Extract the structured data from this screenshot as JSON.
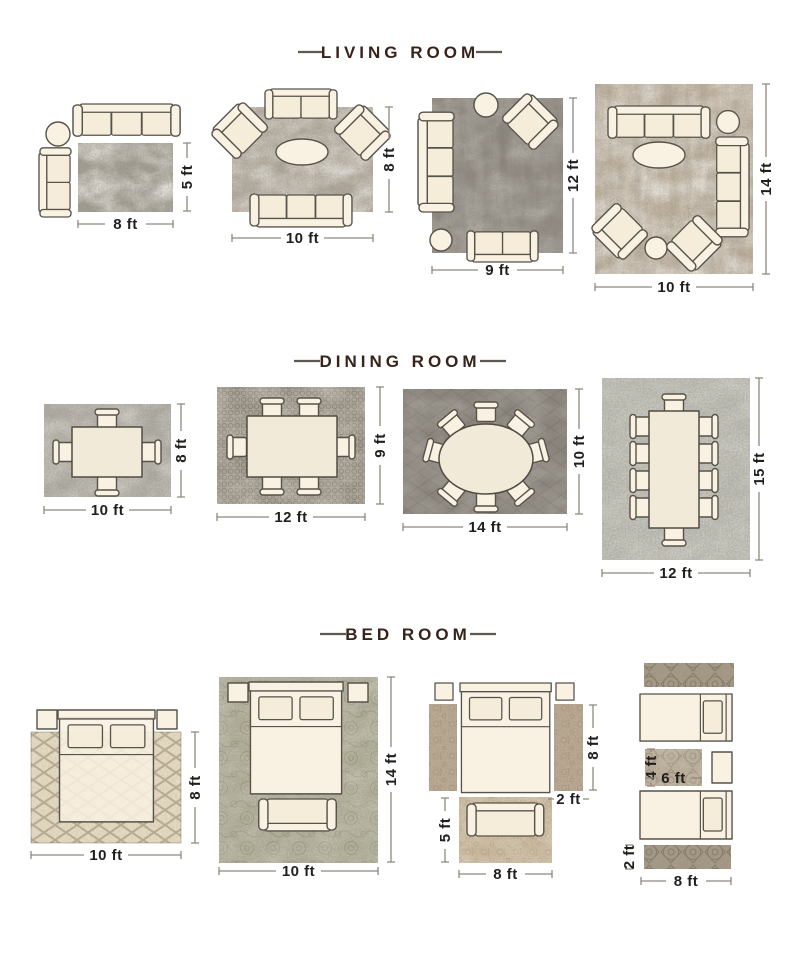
{
  "sections": [
    {
      "title": "LIVING ROOM",
      "layouts": [
        {
          "name": "sofa-corner-rug-8x5",
          "rug_width": "8 ft",
          "rug_height": "5 ft"
        },
        {
          "name": "sofa-set-rug-10x8",
          "rug_width": "10 ft",
          "rug_height": "8 ft"
        },
        {
          "name": "sofa-set-rug-9x12",
          "rug_width": "9 ft",
          "rug_height": "12 ft"
        },
        {
          "name": "sofa-set-rug-10x14",
          "rug_width": "10 ft",
          "rug_height": "14 ft"
        }
      ]
    },
    {
      "title": "DINING ROOM",
      "layouts": [
        {
          "name": "table-4-chairs-rug-10x8",
          "rug_width": "10 ft",
          "rug_height": "8 ft"
        },
        {
          "name": "table-6-chairs-rug-12x9",
          "rug_width": "12 ft",
          "rug_height": "9 ft"
        },
        {
          "name": "oval-table-8-chairs-rug-14x10",
          "rug_width": "14 ft",
          "rug_height": "10 ft"
        },
        {
          "name": "table-10-chairs-rug-12x15",
          "rug_width": "12 ft",
          "rug_height": "15 ft"
        }
      ]
    },
    {
      "title": "BED ROOM",
      "layouts": [
        {
          "name": "bed-on-rug-10x8",
          "rug_width": "10 ft",
          "rug_height": "8 ft"
        },
        {
          "name": "bed-on-rug-10x14",
          "rug_width": "10 ft",
          "rug_height": "14 ft"
        },
        {
          "name": "bed-side-runners-foot-rug",
          "runner_length": "8 ft",
          "runner_width": "2 ft",
          "foot_rug_height": "5 ft",
          "foot_rug_width": "8 ft"
        },
        {
          "name": "twin-beds-runners",
          "center_rug_height": "4 ft",
          "center_rug_width": "6 ft",
          "runner_width": "2 ft",
          "runner_length": "8 ft"
        }
      ]
    }
  ],
  "colors": {
    "background": "#ffffff",
    "heading_text": "#38231a",
    "dimension_text": "#211f1c",
    "dimension_line": "#8d897e",
    "furniture_fill": "#f9f1e1",
    "furniture_outline": "#56534b"
  }
}
